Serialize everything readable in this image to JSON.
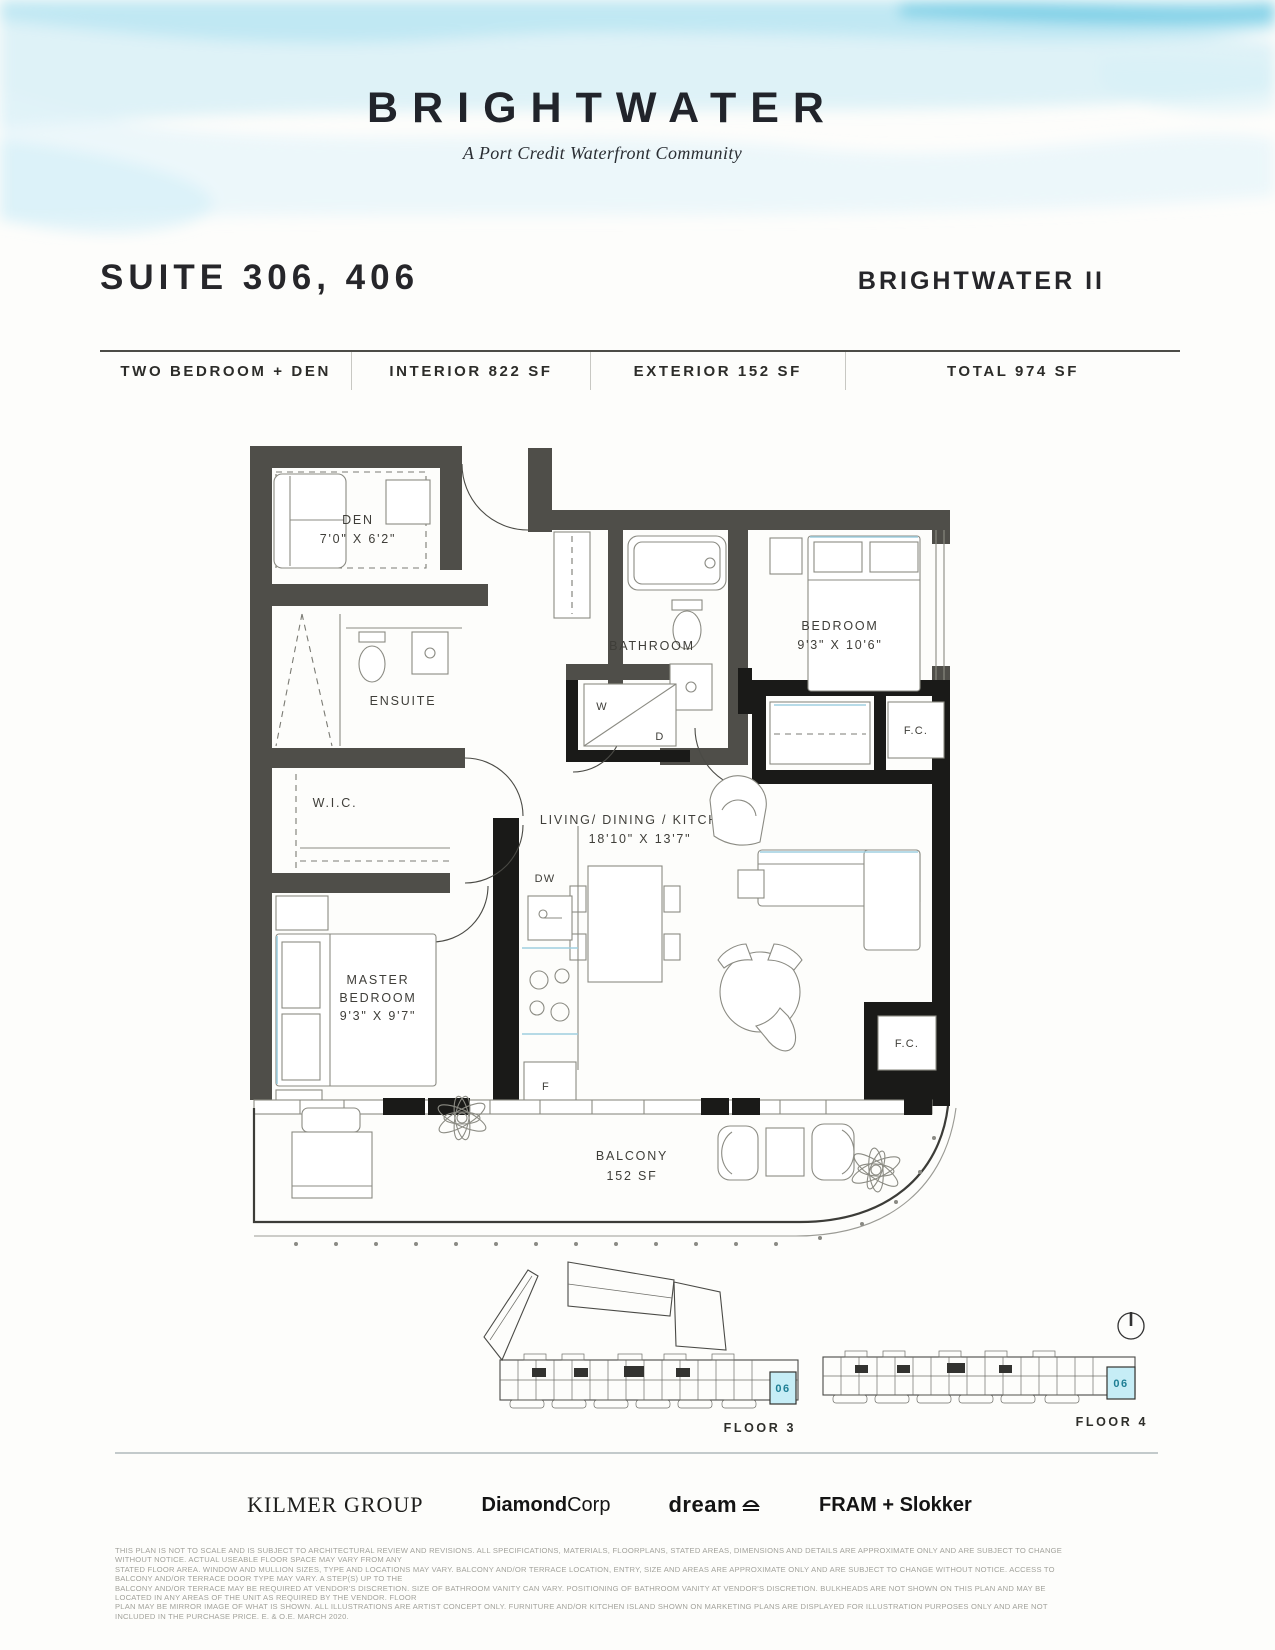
{
  "brand": {
    "name": "BRIGHTWATER",
    "tagline": "A Port Credit Waterfront Community"
  },
  "header": {
    "suite_title": "SUITE 306, 406",
    "project_name": "BRIGHTWATER II"
  },
  "info_bar": {
    "unit_type": "TWO BEDROOM + DEN",
    "interior": "INTERIOR 822 SF",
    "exterior": "EXTERIOR 152 SF",
    "total": "TOTAL 974 SF"
  },
  "plan": {
    "den_name": "DEN",
    "den_dims": "7'0\" X 6'2\"",
    "bathroom_name": "BATHROOM",
    "bedroom_name": "BEDROOM",
    "bedroom_dims": "9'3\" X 10'6\"",
    "ensuite_name": "ENSUITE",
    "wic_name": "W.I.C.",
    "living_name": "LIVING/ DINING / KITCHEN",
    "living_dims": "18'10\" X 13'7\"",
    "master_line1": "MASTER",
    "master_line2": "BEDROOM",
    "master_dims": "9'3\" X 9'7\"",
    "balcony_name": "BALCONY",
    "balcony_dims": "152 SF",
    "washer": "W",
    "dryer": "D",
    "dishwasher": "DW",
    "fridge": "F",
    "fan_coil_top": "F.C.",
    "fan_coil_bottom": "F.C."
  },
  "keyplans": {
    "floor3": {
      "label": "FLOOR 3",
      "unit": "06"
    },
    "floor4": {
      "label": "FLOOR 4",
      "unit": "06"
    }
  },
  "partners": {
    "kilmer": "KILMER GROUP",
    "diamond_bold": "Diamond",
    "diamond_light": "Corp",
    "dream": "dream",
    "fram": "FRAM + Slokker"
  },
  "disclaimer": {
    "line1": "THIS PLAN IS NOT TO SCALE AND IS SUBJECT TO ARCHITECTURAL REVIEW AND REVISIONS. ALL SPECIFICATIONS, MATERIALS, FLOORPLANS, STATED AREAS, DIMENSIONS AND DETAILS ARE APPROXIMATE ONLY AND ARE SUBJECT TO CHANGE WITHOUT NOTICE. ACTUAL USEABLE FLOOR SPACE MAY VARY FROM ANY",
    "line2": "STATED FLOOR AREA. WINDOW AND MULLION SIZES, TYPE AND LOCATIONS MAY VARY. BALCONY AND/OR TERRACE LOCATION, ENTRY, SIZE AND AREAS ARE APPROXIMATE ONLY AND ARE SUBJECT TO CHANGE WITHOUT NOTICE. ACCESS TO BALCONY AND/OR TERRACE DOOR TYPE MAY VARY. A STEP(S) UP TO THE",
    "line3": "BALCONY AND/OR TERRACE MAY BE REQUIRED AT VENDOR'S DISCRETION. SIZE OF BATHROOM VANITY CAN VARY. POSITIONING OF BATHROOM VANITY AT VENDOR'S DISCRETION. BULKHEADS ARE NOT SHOWN ON THIS PLAN AND MAY BE LOCATED IN ANY AREAS OF THE UNIT AS REQUIRED BY THE VENDOR. FLOOR",
    "line4": "PLAN MAY BE MIRROR IMAGE OF WHAT IS SHOWN. ALL ILLUSTRATIONS ARE ARTIST CONCEPT ONLY. FURNITURE AND/OR KITCHEN ISLAND SHOWN ON MARKETING PLANS ARE DISPLAYED FOR ILLUSTRATION PURPOSES ONLY AND ARE NOT INCLUDED IN THE PURCHASE PRICE. E. & O.E. MARCH 2020."
  },
  "colors": {
    "wall_gray": "#4f4e49",
    "wall_black": "#1a1a18",
    "highlight_fill": "#c6edf6",
    "highlight_text": "#1f7f95",
    "wave_accent": "#8ed7ec"
  }
}
